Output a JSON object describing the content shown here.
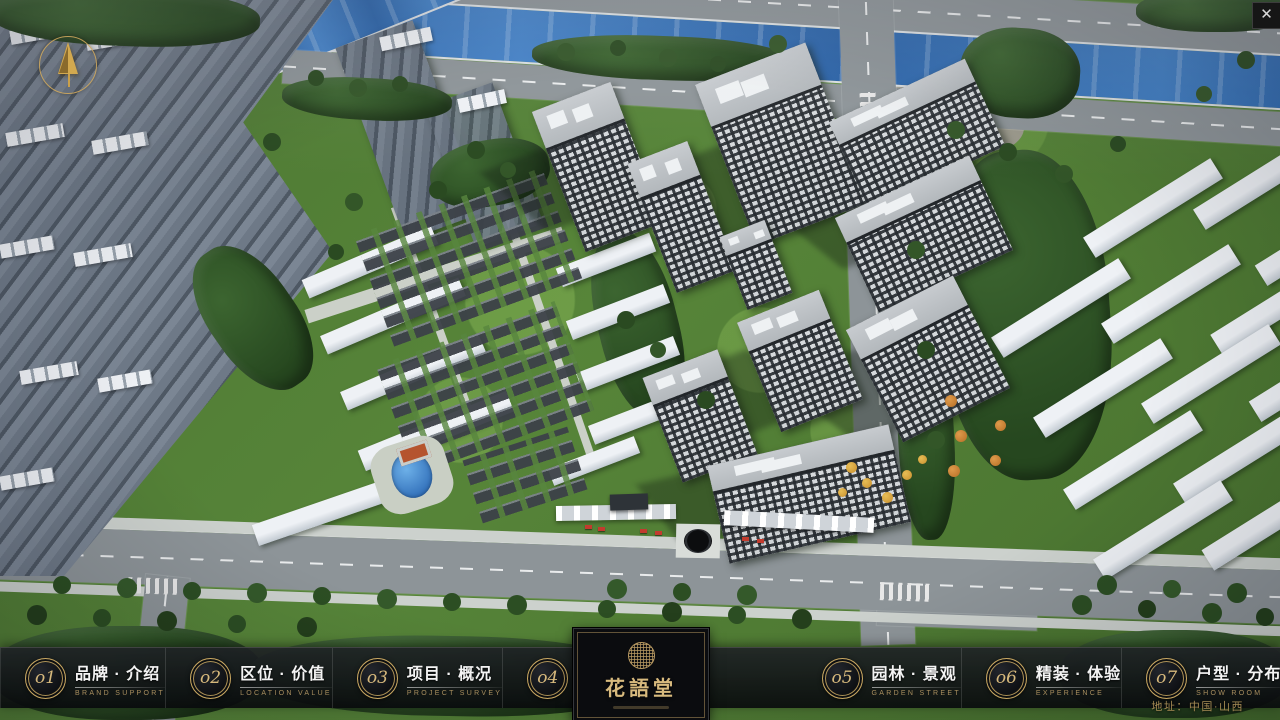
{
  "theme": {
    "accent_gold": "#c9a862",
    "gold_dim": "#a98f5f",
    "bar_background": "#101215",
    "river_blue": "#2f6db8"
  },
  "window": {
    "close_glyph": "✕"
  },
  "nav": {
    "items": [
      {
        "num": "o1",
        "zh": "品牌 · 介绍",
        "en": "BRAND SUPPORT"
      },
      {
        "num": "o2",
        "zh": "区位 · 价值",
        "en": "LOCATION VALUE"
      },
      {
        "num": "o3",
        "zh": "项目 · 概况",
        "en": "PROJECT SURVEY"
      },
      {
        "num": "o4",
        "zh": "建筑 · 鉴赏",
        "en": "APPRECIATION"
      },
      {
        "num": "o5",
        "zh": "园林 · 景观",
        "en": "GARDEN STREET"
      },
      {
        "num": "o6",
        "zh": "精装 · 体验",
        "en": "EXPERIENCE"
      },
      {
        "num": "o7",
        "zh": "户型 · 分布",
        "en": "SHOW ROOM"
      },
      {
        "num": "o8",
        "zh": "一房 · 一景",
        "en": "COMMUNITY"
      }
    ],
    "logo": {
      "title": "花語堂"
    },
    "address": "地址：中国·山西"
  }
}
